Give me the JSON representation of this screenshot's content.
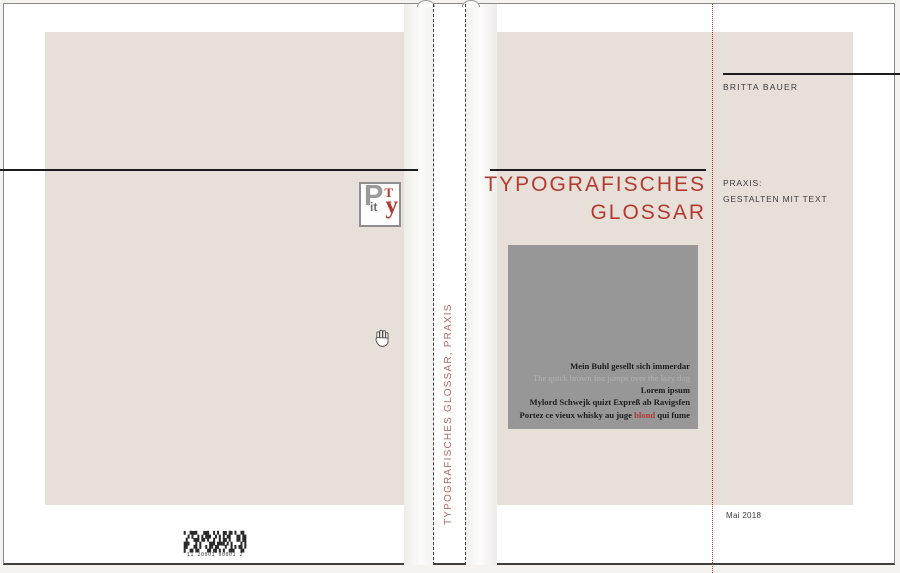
{
  "spine": {
    "label": "TYPOGRAFISCHES GLOSSAR, PRAXIS"
  },
  "back_cover": {
    "logo": {
      "letter_p": "P",
      "letter_t": "T",
      "letters_it": "it",
      "letter_y": "y"
    },
    "barcode": {
      "row1": "▘▞▛▚▗▜▙▝▞▖▛▟▘▚▞▙",
      "row2": "▟▖▝▛▞▘▚▟▗▙▛▞▖▝▚▜",
      "row3": "▛▗▞▙▘▝▟▚▛▖▞▗▙▘▜▞",
      "digits": "11 20001 00001 2"
    }
  },
  "front_cover": {
    "author": "BRITTA BAUER",
    "title_line1": "TYPOGRAFISCHES",
    "title_line2": "GLOSSAR",
    "series_line1": "PRAXIS:",
    "series_line2": "GESTALTEN MIT TEXT",
    "date": "Mai 2018",
    "specimen": {
      "l1": "Mein Buhl gesellt sich immerdar",
      "l2": "The quick brown fox jumps over the lazy dog",
      "l3": "Lorem ipsum",
      "l4": "Mylord Schwejk quizt Expreß ab Ravigsfen",
      "l5_pre": "Portez ce vieux whisky au juge ",
      "l5_accent": "blond",
      "l5_post": " qui fume"
    }
  },
  "colors": {
    "accent_red": "#b23a31",
    "spine_text_red": "#b4695f",
    "cover_beige": "#e7e0d8",
    "specimen_box_gray": "#979797"
  }
}
